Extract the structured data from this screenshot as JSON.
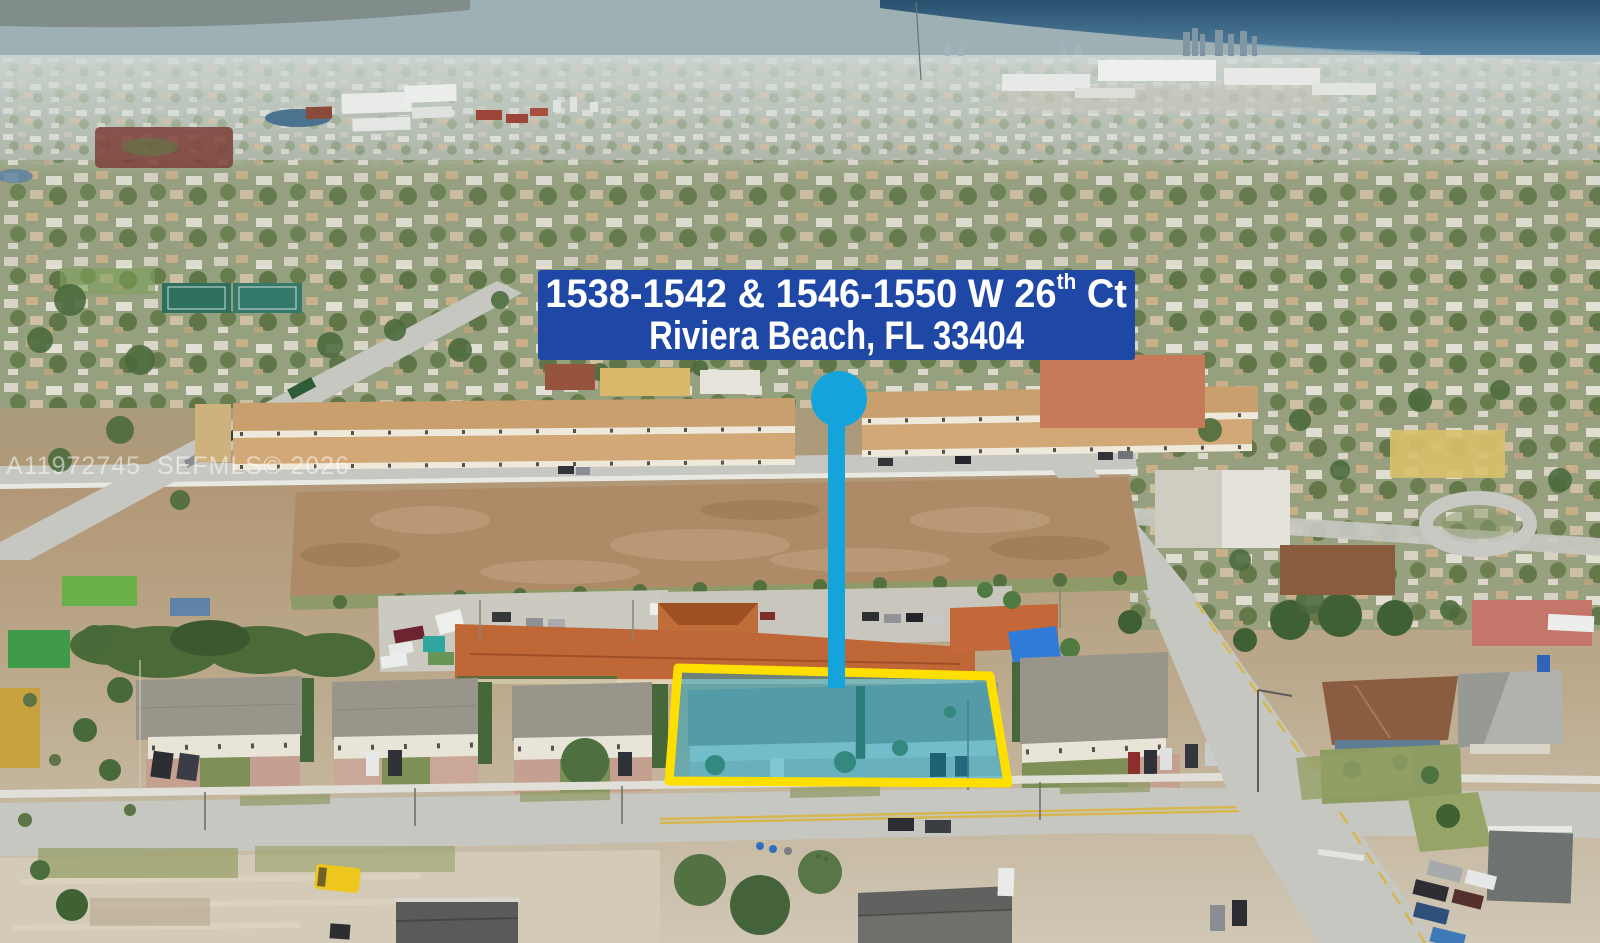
{
  "banner": {
    "line1_prefix": "1538-1542 & 1546-1550 W 26",
    "line1_superscript": "th",
    "line1_suffix": " Ct",
    "line2": "Riviera Beach, FL 33404"
  },
  "watermark": {
    "text": "A11972745  SEFMLS© 2026"
  },
  "colors": {
    "banner_background": "#1f47a6",
    "banner_text": "#ffffff",
    "pin": "#14a3da",
    "highlight_border": "#ffdf00",
    "highlight_fill": "rgba(23,160,190,0.5)",
    "watermark": "rgba(255,255,255,0.52)"
  }
}
